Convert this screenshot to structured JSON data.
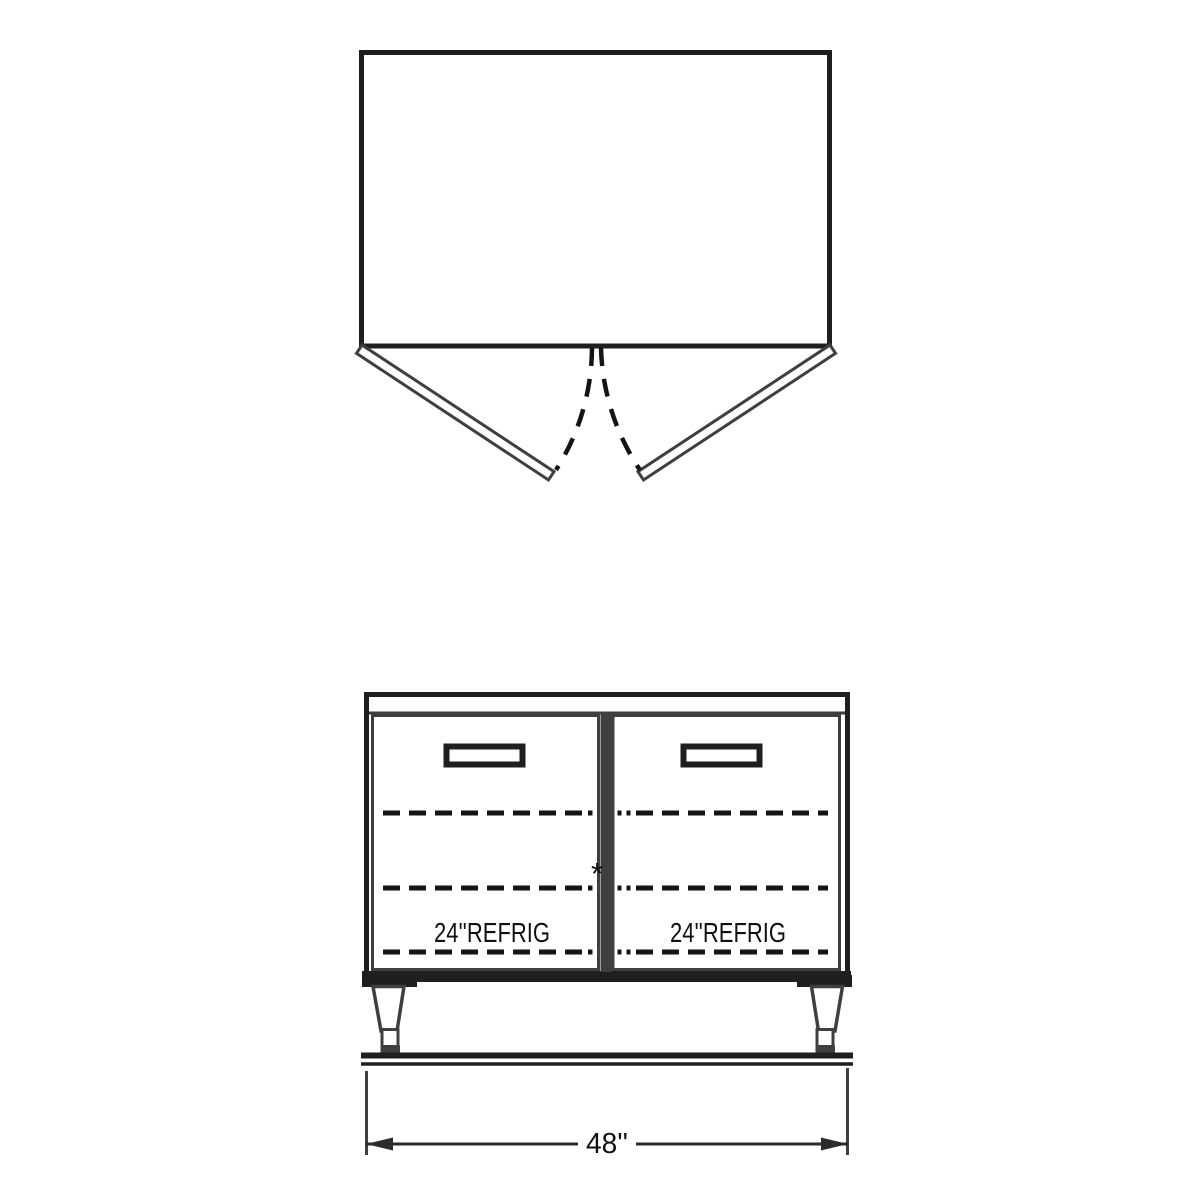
{
  "drawing": {
    "elevation": {
      "left_door_label": "24''REFRIG",
      "right_door_label": "24''REFRIG",
      "note_marker": "*",
      "width_dimension": "48''"
    },
    "colors": {
      "line_primary": "#1f1f1f",
      "line_secondary": "#3f3f3f",
      "dash_line": "#141414",
      "background": "#ffffff"
    }
  }
}
